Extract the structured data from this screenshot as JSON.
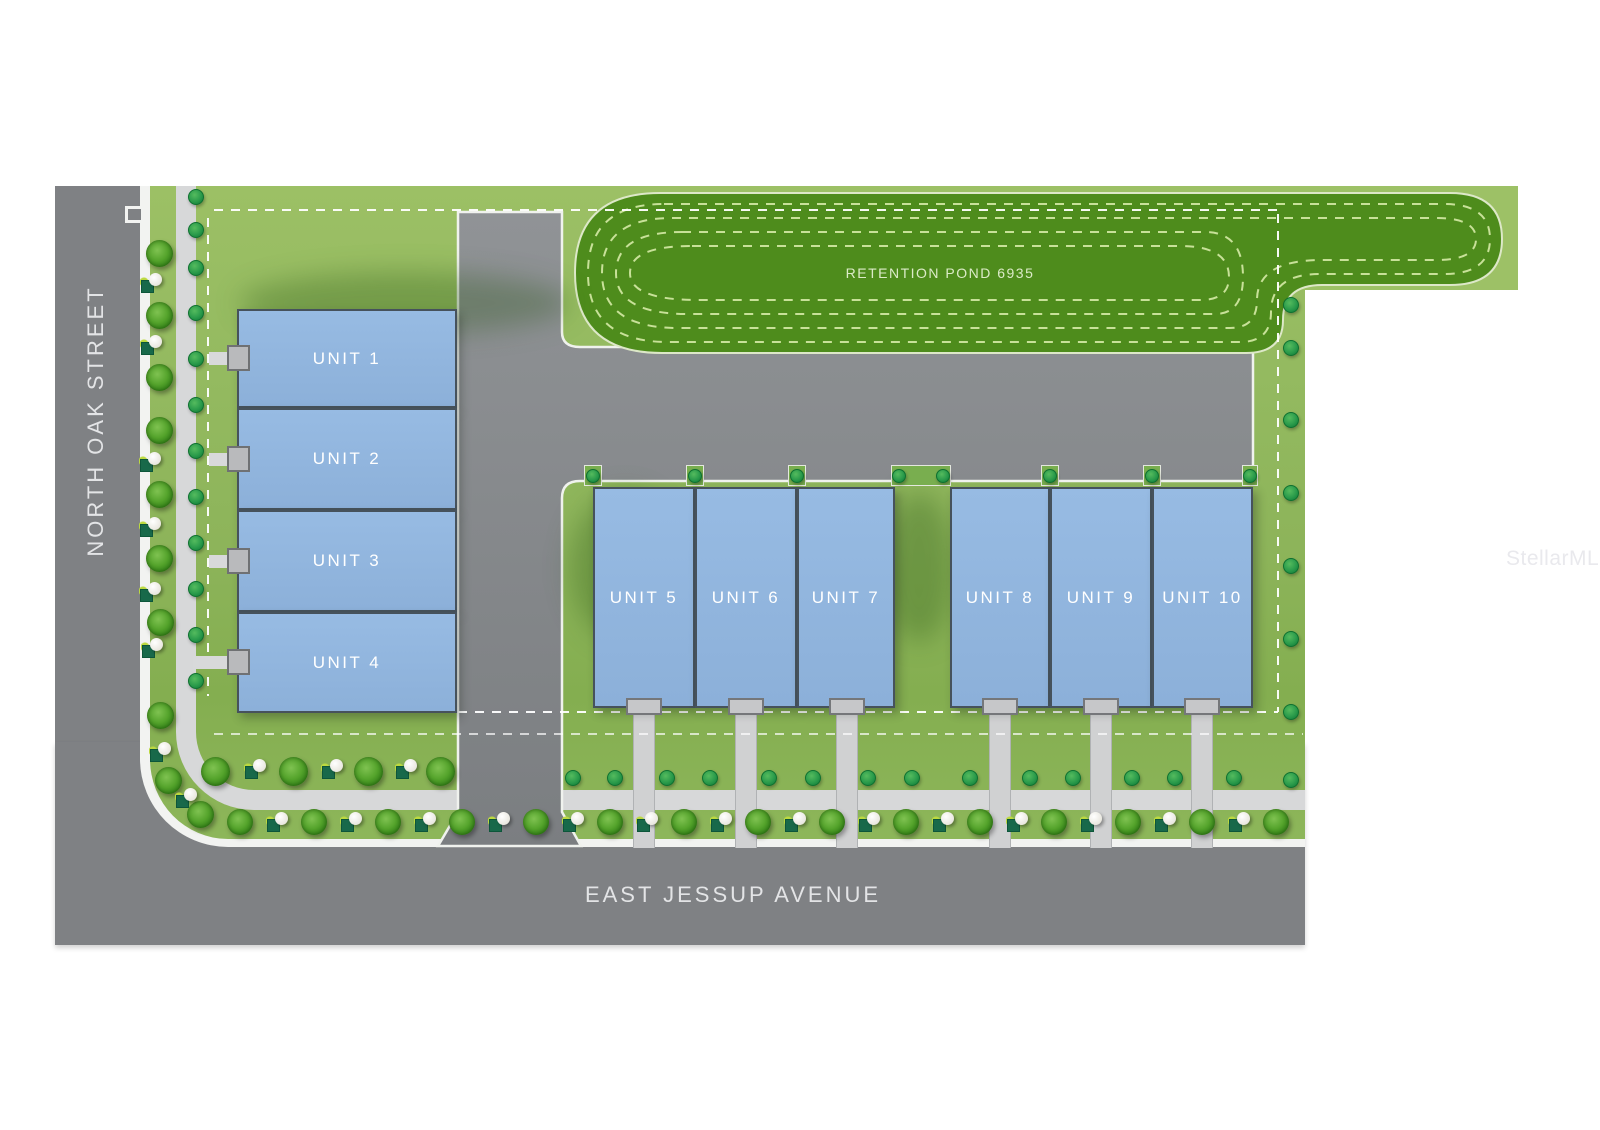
{
  "streets": {
    "west_label": "NORTH OAK STREET",
    "south_label": "EAST JESSUP AVENUE"
  },
  "pond": {
    "label": "RETENTION POND 6935"
  },
  "units": [
    {
      "id": "unit-1",
      "label": "UNIT 1"
    },
    {
      "id": "unit-2",
      "label": "UNIT 2"
    },
    {
      "id": "unit-3",
      "label": "UNIT 3"
    },
    {
      "id": "unit-4",
      "label": "UNIT 4"
    },
    {
      "id": "unit-5",
      "label": "UNIT 5"
    },
    {
      "id": "unit-6",
      "label": "UNIT 6"
    },
    {
      "id": "unit-7",
      "label": "UNIT 7"
    },
    {
      "id": "unit-8",
      "label": "UNIT 8"
    },
    {
      "id": "unit-9",
      "label": "UNIT 9"
    },
    {
      "id": "unit-10",
      "label": "UNIT 10"
    }
  ],
  "watermark": {
    "label": "StellarMLS"
  },
  "colors": {
    "grass": "#93b95e",
    "pond_green": "#4e8c1c",
    "pavement_lot": "#85888b",
    "road": "#7f8184",
    "sidewalk": "#d7d8d9",
    "curb": "#f2f3f1",
    "unit_fill": "#92b6df",
    "unit_border": "#46525c",
    "dashed_line": "#ffffff",
    "tree_green": "#55a42c",
    "label_text": "#ffffff"
  }
}
